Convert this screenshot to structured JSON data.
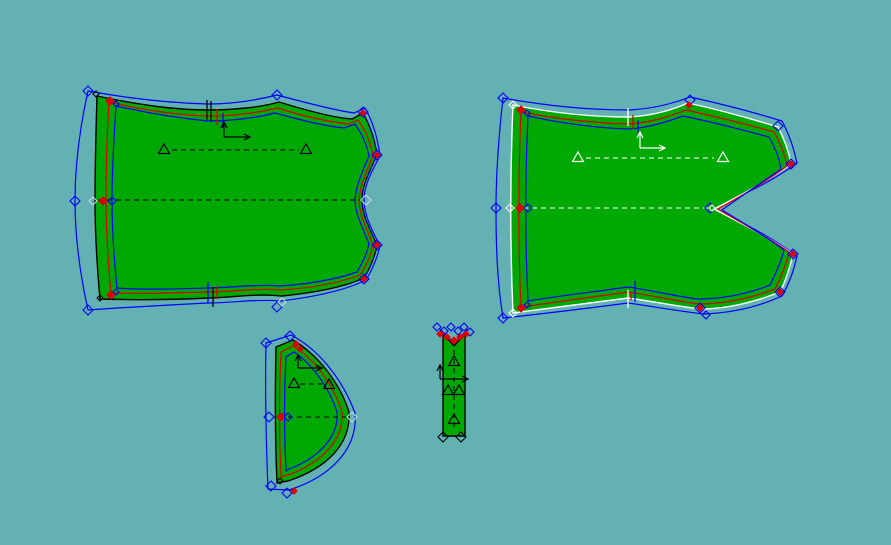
{
  "canvas": {
    "width": 891,
    "height": 545
  },
  "colors": {
    "background": "#63b1b3",
    "piece_fill": "#00a803",
    "outline_dark": "#000000",
    "outline_light": "#ffffff",
    "seam_line": "#dd0000",
    "offset_line": "#0000ff",
    "ghost_marker": "#bfdcd8"
  },
  "pieces": [
    {
      "label": "front-panel",
      "markers": [
        {
          "x": 88,
          "y": 91,
          "c": "blue",
          "s": 5
        },
        {
          "x": 96,
          "y": 94,
          "c": "black",
          "s": 3
        },
        {
          "x": 110,
          "y": 101,
          "c": "red",
          "s": 4
        },
        {
          "x": 116,
          "y": 104,
          "c": "blue",
          "s": 3
        },
        {
          "x": 277,
          "y": 95,
          "c": "blue",
          "s": 5
        },
        {
          "x": 363,
          "y": 112,
          "c": "blue",
          "s": 5
        },
        {
          "x": 363,
          "y": 113,
          "c": "red",
          "s": 3
        },
        {
          "x": 377,
          "y": 155,
          "c": "blue",
          "s": 5
        },
        {
          "x": 377,
          "y": 155,
          "c": "red",
          "s": 3
        },
        {
          "x": 366,
          "y": 200,
          "c": "ghost",
          "s": 5
        },
        {
          "x": 377,
          "y": 245,
          "c": "blue",
          "s": 5
        },
        {
          "x": 377,
          "y": 245,
          "c": "red",
          "s": 3
        },
        {
          "x": 364,
          "y": 279,
          "c": "blue",
          "s": 5
        },
        {
          "x": 364,
          "y": 279,
          "c": "red",
          "s": 3
        },
        {
          "x": 277,
          "y": 307,
          "c": "blue",
          "s": 5
        },
        {
          "x": 282,
          "y": 302,
          "c": "ghost",
          "s": 4
        },
        {
          "x": 88,
          "y": 310,
          "c": "blue",
          "s": 5
        },
        {
          "x": 100,
          "y": 298,
          "c": "black",
          "s": 3
        },
        {
          "x": 111,
          "y": 295,
          "c": "red",
          "s": 4
        },
        {
          "x": 116,
          "y": 292,
          "c": "blue",
          "s": 3
        },
        {
          "x": 75,
          "y": 201,
          "c": "blue",
          "s": 5
        },
        {
          "x": 93,
          "y": 201,
          "c": "ghost",
          "s": 4
        },
        {
          "x": 103,
          "y": 201,
          "c": "red",
          "s": 4
        },
        {
          "x": 112,
          "y": 201,
          "c": "blue",
          "s": 4
        }
      ],
      "ticks": [
        {
          "x": 207,
          "y1": 100,
          "y2": 120,
          "c": "black"
        },
        {
          "x": 211,
          "y1": 101,
          "y2": 121,
          "c": "black"
        },
        {
          "x": 217,
          "y1": 109,
          "y2": 125,
          "c": "red"
        },
        {
          "x": 223,
          "y1": 113,
          "y2": 128,
          "c": "blue"
        },
        {
          "x": 208,
          "y1": 282,
          "y2": 303,
          "c": "blue"
        },
        {
          "x": 213,
          "y1": 287,
          "y2": 307,
          "c": "black"
        },
        {
          "x": 217,
          "y1": 286,
          "y2": 299,
          "c": "red"
        }
      ],
      "triangles": [
        {
          "x": 164,
          "y": 150,
          "c": "black"
        },
        {
          "x": 306,
          "y": 150,
          "c": "black"
        }
      ],
      "axes": [
        {
          "x": 224,
          "y": 137,
          "up": 15,
          "right": 26,
          "c": "black"
        }
      ]
    },
    {
      "label": "back-panel",
      "markers": [
        {
          "x": 503,
          "y": 98,
          "c": "blue",
          "s": 5
        },
        {
          "x": 513,
          "y": 105,
          "c": "white",
          "s": 4
        },
        {
          "x": 521,
          "y": 110,
          "c": "red",
          "s": 4
        },
        {
          "x": 527,
          "y": 113,
          "c": "blue",
          "s": 3
        },
        {
          "x": 690,
          "y": 100,
          "c": "blue",
          "s": 5
        },
        {
          "x": 689,
          "y": 105,
          "c": "red",
          "s": 3
        },
        {
          "x": 778,
          "y": 126,
          "c": "blue",
          "s": 5
        },
        {
          "x": 791,
          "y": 164,
          "c": "blue",
          "s": 5
        },
        {
          "x": 791,
          "y": 164,
          "c": "red",
          "s": 3
        },
        {
          "x": 710,
          "y": 208,
          "c": "blue",
          "s": 5
        },
        {
          "x": 712,
          "y": 208,
          "c": "white",
          "s": 3
        },
        {
          "x": 793,
          "y": 254,
          "c": "blue",
          "s": 5
        },
        {
          "x": 793,
          "y": 254,
          "c": "red",
          "s": 3
        },
        {
          "x": 780,
          "y": 292,
          "c": "blue",
          "s": 5
        },
        {
          "x": 780,
          "y": 292,
          "c": "red",
          "s": 3
        },
        {
          "x": 700,
          "y": 308,
          "c": "blue",
          "s": 5
        },
        {
          "x": 700,
          "y": 308,
          "c": "red",
          "s": 3
        },
        {
          "x": 706,
          "y": 315,
          "c": "blue",
          "s": 4
        },
        {
          "x": 503,
          "y": 318,
          "c": "blue",
          "s": 5
        },
        {
          "x": 513,
          "y": 313,
          "c": "white",
          "s": 4
        },
        {
          "x": 521,
          "y": 308,
          "c": "red",
          "s": 4
        },
        {
          "x": 527,
          "y": 305,
          "c": "blue",
          "s": 3
        },
        {
          "x": 496,
          "y": 208,
          "c": "blue",
          "s": 5
        },
        {
          "x": 510,
          "y": 208,
          "c": "white",
          "s": 4
        },
        {
          "x": 520,
          "y": 208,
          "c": "red",
          "s": 4
        },
        {
          "x": 528,
          "y": 208,
          "c": "blue",
          "s": 4
        }
      ],
      "ticks": [
        {
          "x": 628,
          "y1": 108,
          "y2": 126,
          "c": "white"
        },
        {
          "x": 633,
          "y1": 115,
          "y2": 129,
          "c": "red"
        },
        {
          "x": 638,
          "y1": 120,
          "y2": 133,
          "c": "blue"
        },
        {
          "x": 628,
          "y1": 290,
          "y2": 308,
          "c": "white"
        },
        {
          "x": 635,
          "y1": 281,
          "y2": 302,
          "c": "blue"
        },
        {
          "x": 631,
          "y1": 292,
          "y2": 300,
          "c": "red"
        }
      ],
      "triangles": [
        {
          "x": 578,
          "y": 158,
          "c": "white"
        },
        {
          "x": 723,
          "y": 158,
          "c": "white"
        }
      ],
      "axes": [
        {
          "x": 640,
          "y": 148,
          "up": 16,
          "right": 25,
          "c": "white"
        }
      ]
    },
    {
      "label": "side-piece",
      "markers": [
        {
          "x": 266,
          "y": 343,
          "c": "blue",
          "s": 5
        },
        {
          "x": 290,
          "y": 336,
          "c": "blue",
          "s": 5
        },
        {
          "x": 296,
          "y": 344,
          "c": "red",
          "s": 3
        },
        {
          "x": 300,
          "y": 349,
          "c": "red",
          "s": 3
        },
        {
          "x": 269,
          "y": 417,
          "c": "blue",
          "s": 5
        },
        {
          "x": 281,
          "y": 417,
          "c": "red",
          "s": 4
        },
        {
          "x": 288,
          "y": 417,
          "c": "blue",
          "s": 4
        },
        {
          "x": 352,
          "y": 417,
          "c": "ghost",
          "s": 5
        },
        {
          "x": 271,
          "y": 486,
          "c": "blue",
          "s": 5
        },
        {
          "x": 287,
          "y": 493,
          "c": "blue",
          "s": 5
        },
        {
          "x": 294,
          "y": 491,
          "c": "red",
          "s": 3
        },
        {
          "x": 280,
          "y": 481,
          "c": "black",
          "s": 3
        }
      ],
      "ticks": [],
      "triangles": [
        {
          "x": 294,
          "y": 384,
          "c": "black"
        },
        {
          "x": 329,
          "y": 385,
          "c": "black"
        }
      ],
      "axes": [
        {
          "x": 298,
          "y": 368,
          "up": 13,
          "right": 24,
          "c": "black"
        }
      ]
    },
    {
      "label": "strap",
      "markers": [
        {
          "x": 437,
          "y": 327,
          "c": "blue",
          "s": 4
        },
        {
          "x": 444,
          "y": 331,
          "c": "blue",
          "s": 4
        },
        {
          "x": 451,
          "y": 327,
          "c": "blue",
          "s": 4
        },
        {
          "x": 458,
          "y": 331,
          "c": "blue",
          "s": 4
        },
        {
          "x": 464,
          "y": 327,
          "c": "blue",
          "s": 4
        },
        {
          "x": 470,
          "y": 332,
          "c": "blue",
          "s": 4
        },
        {
          "x": 440,
          "y": 334,
          "c": "red",
          "s": 3
        },
        {
          "x": 447,
          "y": 337,
          "c": "red",
          "s": 3
        },
        {
          "x": 454,
          "y": 340,
          "c": "red",
          "s": 3
        },
        {
          "x": 460,
          "y": 337,
          "c": "red",
          "s": 3
        },
        {
          "x": 466,
          "y": 334,
          "c": "red",
          "s": 3
        },
        {
          "x": 443,
          "y": 437,
          "c": "black",
          "s": 5
        },
        {
          "x": 461,
          "y": 437,
          "c": "black",
          "s": 5
        }
      ],
      "ticks": [],
      "triangles": [
        {
          "x": 454,
          "y": 362,
          "c": "black"
        },
        {
          "x": 448,
          "y": 391,
          "c": "black"
        },
        {
          "x": 459,
          "y": 391,
          "c": "black"
        },
        {
          "x": 454,
          "y": 420,
          "c": "black"
        }
      ],
      "axes": [
        {
          "x": 440,
          "y": 379,
          "up": 14,
          "right": 28,
          "c": "black"
        }
      ]
    }
  ]
}
